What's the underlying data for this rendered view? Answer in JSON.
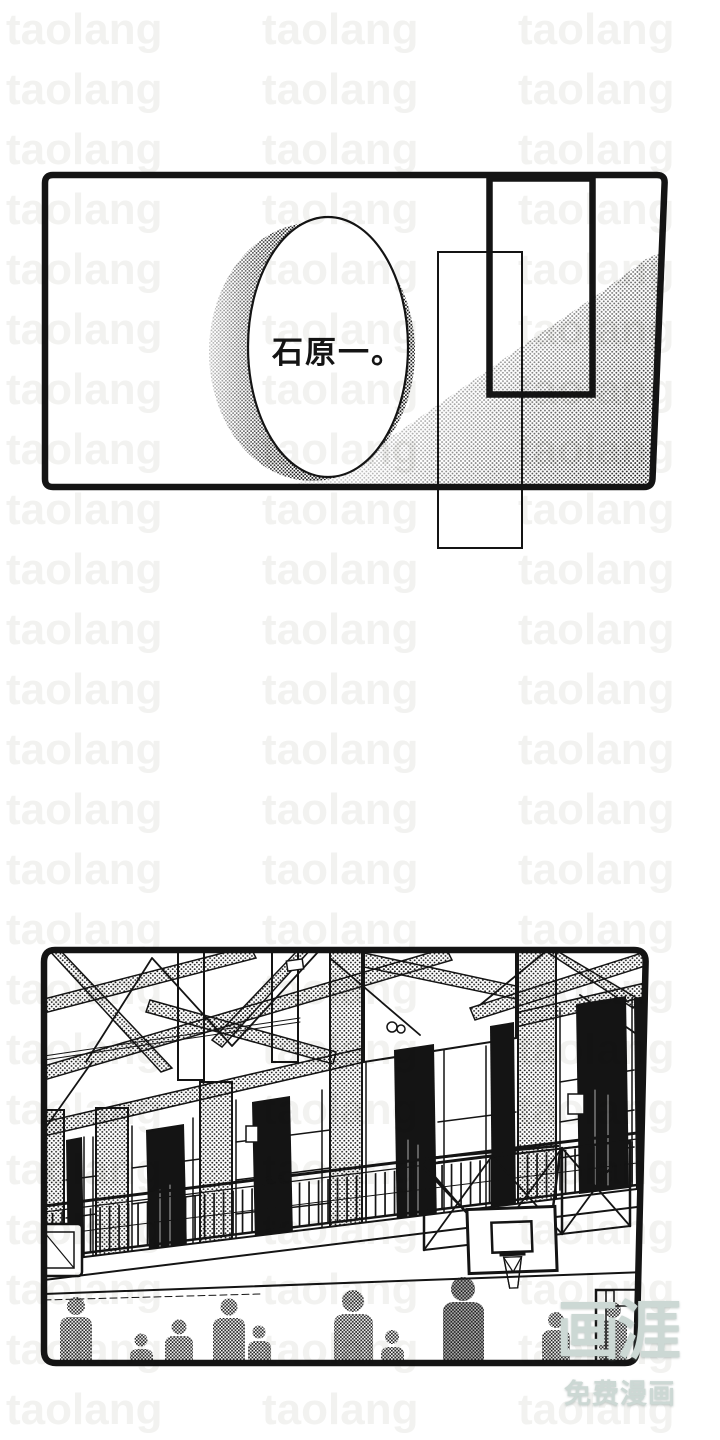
{
  "page": {
    "background_color": "#ffffff",
    "ink_color": "#141414"
  },
  "ghost_watermark": {
    "text": "taolang",
    "color": "#f2f2f0"
  },
  "top_panel": {
    "speech_text": "石原一。"
  },
  "site_watermark": {
    "logo_text": "画涯",
    "tagline": "免费漫画",
    "color": "#ccd8d4"
  }
}
